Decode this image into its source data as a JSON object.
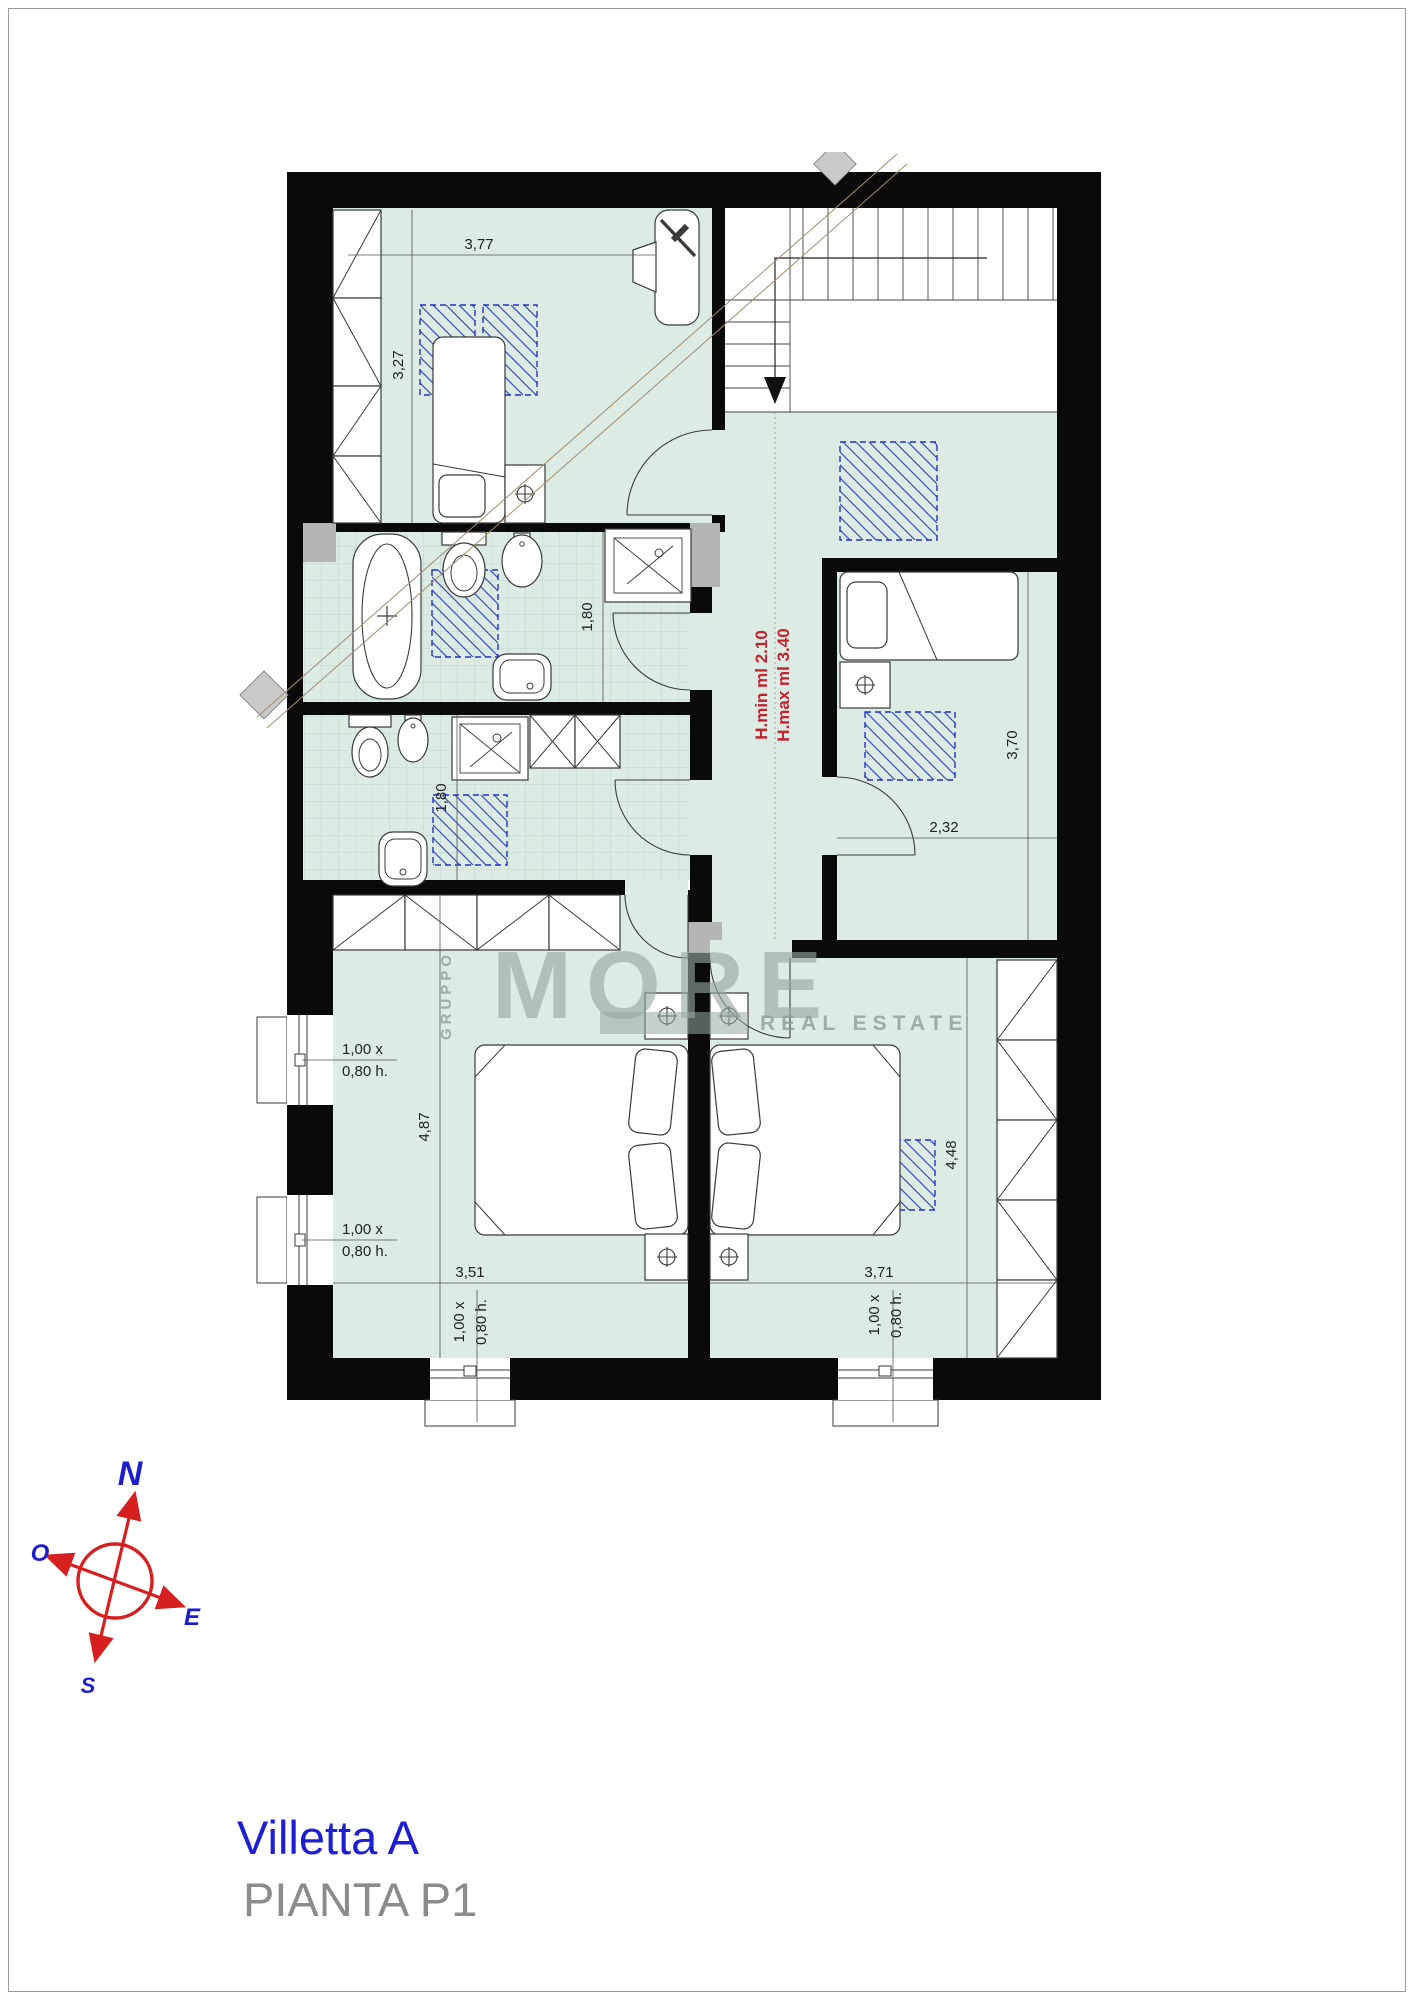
{
  "title_block": {
    "project_name": "Villetta A",
    "drawing_name": "PIANTA  P1"
  },
  "compass": {
    "north": "N",
    "west": "O",
    "east": "E",
    "south": "S"
  },
  "watermark": {
    "group_label": "GRUPPO",
    "brand": "MORE",
    "tagline": "REAL ESTATE"
  },
  "plan": {
    "height_note": {
      "line1": "H.min ml 2.10",
      "line2": "H.max ml 3.40",
      "color": "#c2232f"
    },
    "window_label": {
      "line1": "1,00 x",
      "line2": "0,80 h."
    },
    "dimensions": {
      "bedroom_nw_width": "3,77",
      "bedroom_nw_depth": "3,27",
      "bathroom_top_width": "1,80",
      "bathroom_bottom_width": "1,80",
      "bedroom_e_depth": "3,70",
      "bedroom_e_width": "2,32",
      "bedroom_sw_depth": "4,87",
      "bedroom_sw_width": "3,51",
      "bedroom_se_depth": "4,48",
      "bedroom_se_width": "3,71"
    }
  }
}
